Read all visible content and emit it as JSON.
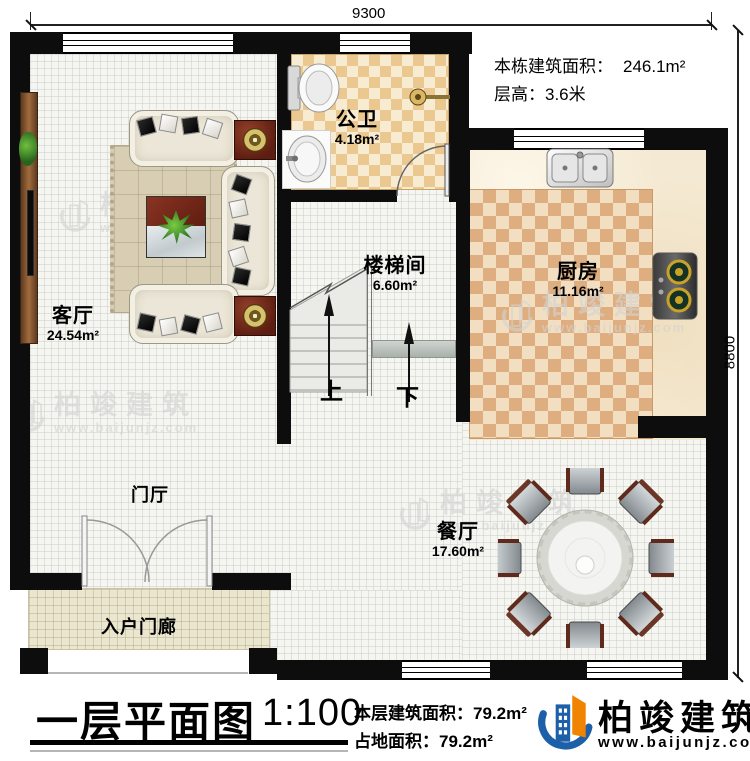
{
  "dimensions": {
    "top_width": "9300",
    "right_height": "8800"
  },
  "building_info": {
    "total_area_label": "本栋建筑面积：",
    "total_area_value": "246.1m²",
    "floor_height_label": "层高：",
    "floor_height_value": "3.6米"
  },
  "rooms": {
    "bathroom": {
      "name": "公卫",
      "area": "4.18m²"
    },
    "kitchen": {
      "name": "厨房",
      "area": "11.16m²"
    },
    "stairwell": {
      "name": "楼梯间",
      "area": "6.60m²"
    },
    "living_room": {
      "name": "客厅",
      "area": "24.54m²"
    },
    "dining_room": {
      "name": "餐厅",
      "area": "17.60m²"
    },
    "foyer": {
      "name": "门厅"
    },
    "entry_porch": {
      "name": "入户门廊"
    }
  },
  "stairs": {
    "up_label": "上",
    "down_label": "下"
  },
  "title_block": {
    "title": "一层平面图",
    "scale": "1:100",
    "floor_area_label": "本层建筑面积：",
    "floor_area_value": "79.2m²",
    "footprint_label": "占地面积：",
    "footprint_value": "79.2m²"
  },
  "brand": {
    "name": "柏竣建筑",
    "website": "www.baijunjz.com"
  },
  "watermark": {
    "name": "柏竣建筑",
    "website": "www.baijunjz.com"
  },
  "colors": {
    "wall": "#0d0d0d",
    "brand-blue": "#1d5fa8",
    "brand-orange": "#f08300",
    "checker-light": "#f7ecd2",
    "checker-dark": "#eac88f",
    "carpet-light": "#f2dfc2",
    "carpet-dark": "#dfae80",
    "porch-floor": "#eae6cf"
  }
}
